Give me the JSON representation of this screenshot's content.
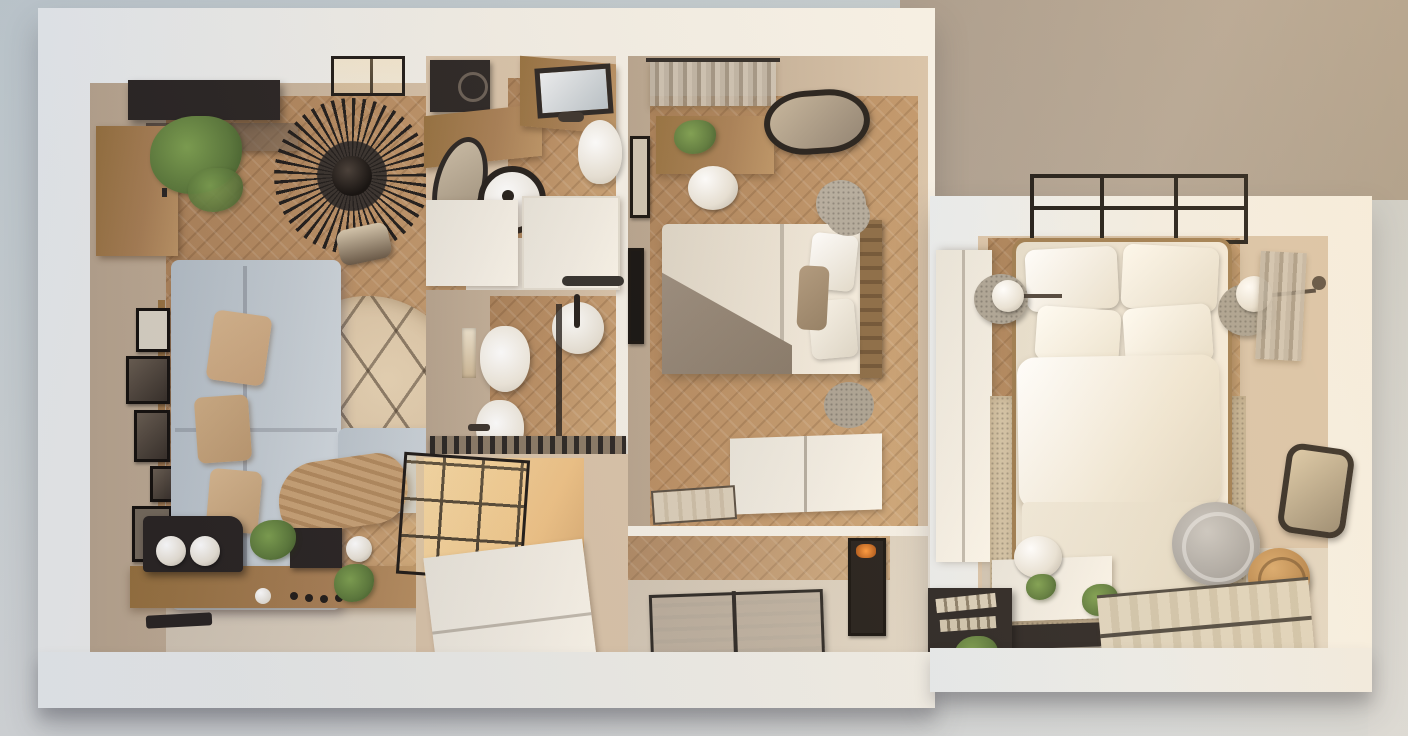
{
  "scene": {
    "type": "photorealistic 3d floor-plan render",
    "view": "top-down dollhouse cutaway of a two-bedroom apartment",
    "lighting": "warm afternoon sunlight entering from the upper right",
    "floor_material": "oak herringbone parquet",
    "rooms": [
      {
        "id": "living-room",
        "name": "Living room + kitchen",
        "furniture": [
          "media-console",
          "glass-shelf",
          "wood-door",
          "large-plant",
          "skylight-window",
          "vertigo-pendant-table",
          "dining-chair",
          "gallery-frames",
          "sectional-sofa",
          "sofa-cushions",
          "throw-blanket",
          "round-zigzag-rug",
          "kitchen-counter",
          "range-hood",
          "pendant-lamps",
          "cooktop",
          "kitchen-knobs",
          "counter-plants",
          "serving-tray"
        ]
      },
      {
        "id": "bathroom-top",
        "name": "Bathroom / laundry",
        "furniture": [
          "washing-machine",
          "wood-counter",
          "oval-mirror",
          "washer-drum",
          "vanity-counter",
          "vanity-sink",
          "toilet-upper"
        ]
      },
      {
        "id": "storage-middle",
        "name": "Hall cabinets",
        "furniture": [
          "white-cabinet-left",
          "white-cabinet-right"
        ]
      },
      {
        "id": "toilet-room",
        "name": "WC",
        "furniture": [
          "toilet",
          "bidet",
          "round-basin",
          "towel-rail",
          "glass-divider",
          "wall-niche"
        ]
      },
      {
        "id": "entry-hall",
        "name": "Entry hall",
        "furniture": [
          "glass-partition",
          "shoe-cabinet",
          "metal-grate-shelf",
          "sunlight-patch"
        ]
      },
      {
        "id": "bedroom-1",
        "name": "Bedroom 1",
        "furniture": [
          "window-curtain",
          "desk",
          "desk-plant",
          "desk-chair",
          "oval-wall-mirror",
          "pouf",
          "wall-frame",
          "wall-tv",
          "double-bed",
          "headboard",
          "bed-pillows",
          "folded-blanket",
          "side-table-top",
          "side-table-bottom",
          "white-dresser",
          "door-mat",
          "radiator-rack",
          "framed-art"
        ]
      },
      {
        "id": "bedroom-2",
        "name": "Bedroom 2 (annex)",
        "furniture": [
          "wardrobe",
          "canopy-frame",
          "brass-bed",
          "bed2-pillows",
          "duvet",
          "bed-rug",
          "nightstand-left",
          "nightstand-right",
          "sphere-lamp-left",
          "sphere-lamp-right",
          "wall-curtain",
          "desk-2",
          "desk-chair-2",
          "laptop",
          "black-shelf",
          "shelf-books",
          "shelf-plants",
          "lounge-chair",
          "rattan-side-table",
          "rounded-mirror",
          "striped-runner-rug"
        ]
      }
    ]
  },
  "palette": {
    "bg_top_left": "#c2ccd1",
    "bg_top_right": "#a89a8b",
    "bg_bottom": "#d6d9da",
    "outer_wall": "#f3efe6",
    "outer_wall_shade": "#e7ebee",
    "inner_wall": "#d8c3a9",
    "inner_wall_shadow": "#b7a48e",
    "floor_wood": "#b98e63",
    "floor_wood_light": "#cfa87a",
    "sofa": "#c5cdd3",
    "cushion": "#c9a47c",
    "rug": "#d9c2a2",
    "dark": "#2b2624",
    "wood_furniture": "#a87f55",
    "white_furniture": "#f2ede3",
    "bedding": "#ece4d6",
    "blanket": "#9c8e7f",
    "plant": "#5d7a3c",
    "brass": "#9c7a4e",
    "sunlight": "#f5d9a8"
  }
}
